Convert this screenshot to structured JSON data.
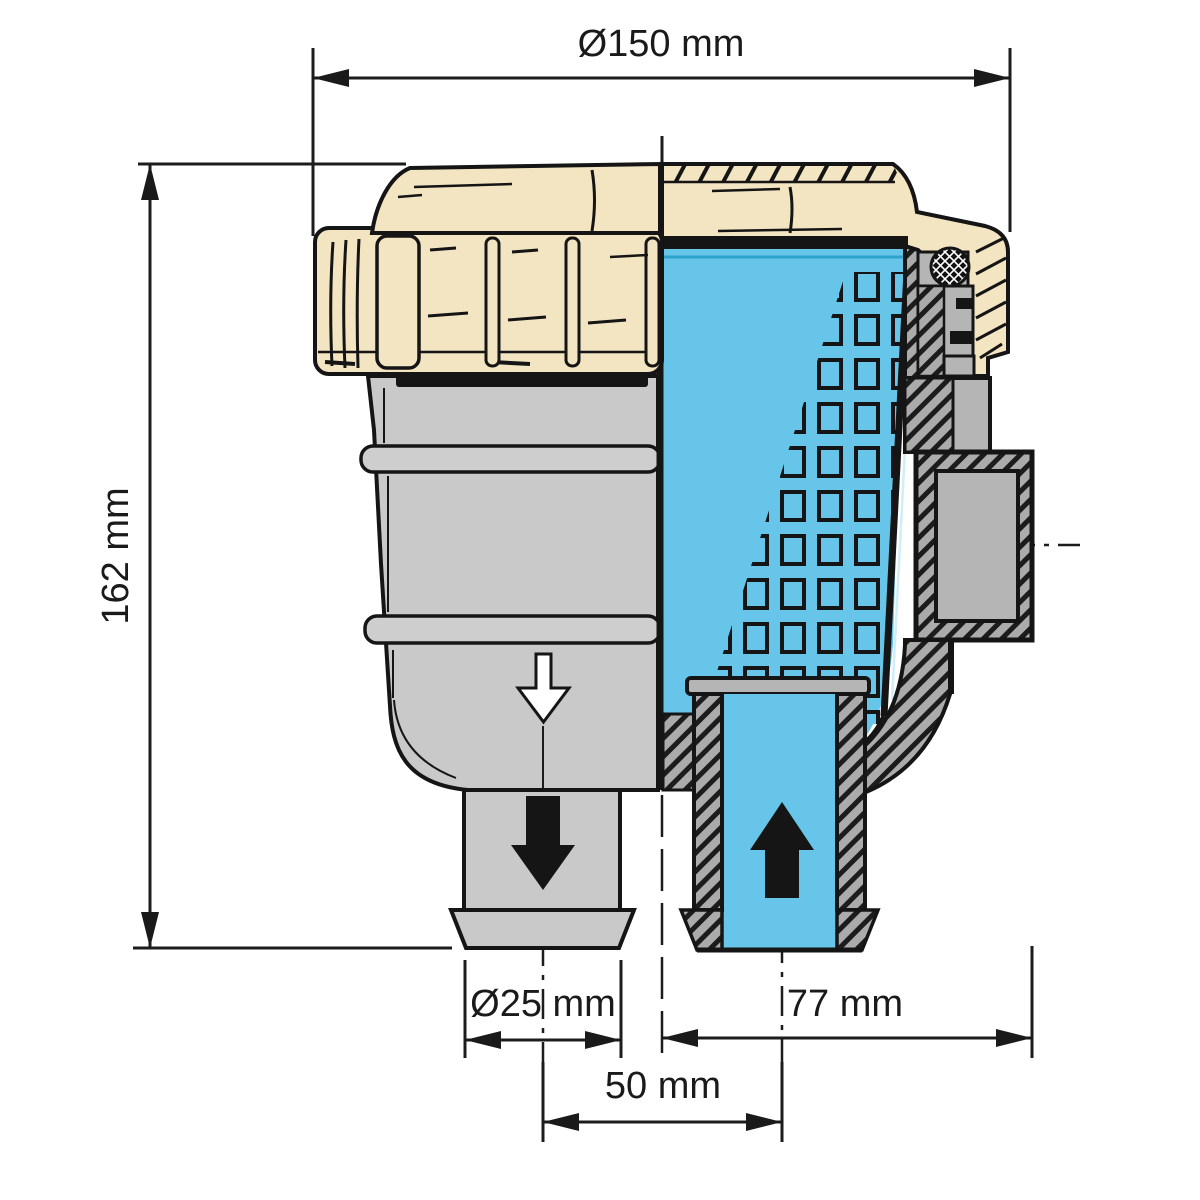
{
  "diagram": {
    "type": "technical cross-section drawing",
    "subject": "raw water strainer (half exterior view, half cutaway)",
    "labels": {
      "top_diameter": "Ø150 mm",
      "overall_height": "162 mm",
      "hose_diameter": "Ø25 mm",
      "center_to_outlet": "77 mm",
      "pipe_center_spacing": "50 mm"
    },
    "colors": {
      "lid_cream": "#f3e5c1",
      "body_gray": "#c9c9c9",
      "section_gray": "#b5b5b5",
      "water_blue": "#66c5e8",
      "outline_black": "#151515",
      "background": "#ffffff"
    },
    "icons": {
      "flow_in": "up-arrow",
      "flow_out": "down-arrow",
      "drain_direction": "hollow-down-arrow"
    }
  }
}
